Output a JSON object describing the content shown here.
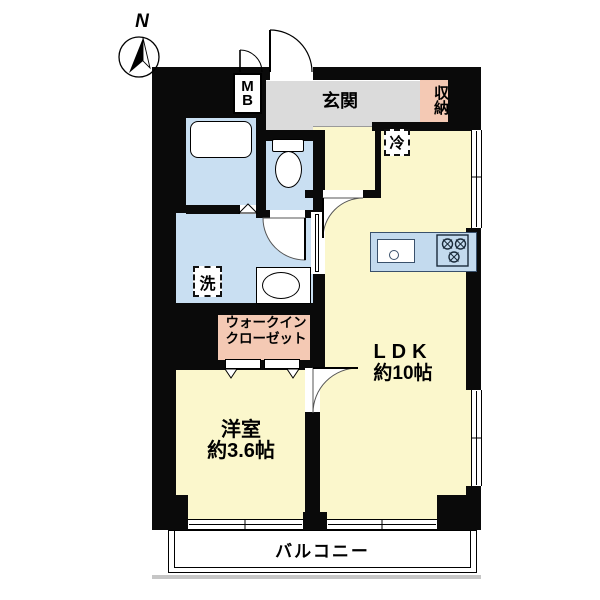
{
  "compass": {
    "label": "N"
  },
  "meter_box": {
    "top": "M",
    "bottom": "B"
  },
  "entrance": {
    "label": "玄関"
  },
  "storage": {
    "label": "収納"
  },
  "refrigerator": {
    "label": "冷"
  },
  "washer": {
    "label": "洗"
  },
  "walk_in_closet": {
    "line1": "ウォークイン",
    "line2": "クローゼット"
  },
  "ldk": {
    "name": "LDK",
    "size": "約10帖"
  },
  "western_room": {
    "name": "洋室",
    "size": "約3.6帖"
  },
  "balcony": {
    "label": "バルコニー"
  },
  "colors": {
    "room_yellow": "#FBF7CC",
    "wet_area_blue": "#C9DFF2",
    "closet_pink": "#F4C9B4",
    "entrance_gray": "#DBDBDB",
    "wall_black": "#0A0A0A",
    "counter_blue": "#C3DAEE"
  }
}
